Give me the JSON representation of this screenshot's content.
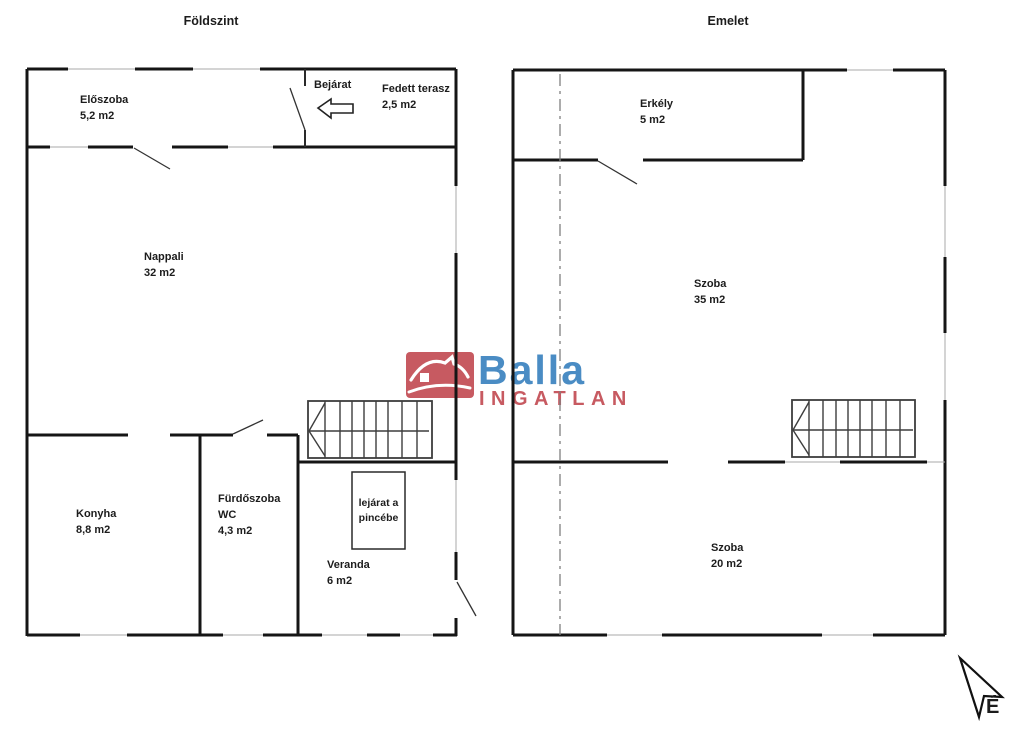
{
  "floors": {
    "ground": {
      "title": "Földszint",
      "rooms": {
        "eloszoba": {
          "name": "Előszoba",
          "area": "5,2 m2"
        },
        "bejarat": {
          "name": "Bejárat"
        },
        "fedett_terasz": {
          "name": "Fedett terasz",
          "area": "2,5 m2"
        },
        "nappali": {
          "name": "Nappali",
          "area": "32 m2"
        },
        "konyha": {
          "name": "Konyha",
          "area": "8,8 m2"
        },
        "furdoszoba": {
          "name": "Fürdőszoba",
          "name2": "WC",
          "area": "4,3 m2"
        },
        "veranda": {
          "name": "Veranda",
          "area": "6 m2"
        },
        "lejarat_pince": {
          "line1": "lejárat a",
          "line2": "pincébe"
        }
      }
    },
    "upper": {
      "title": "Emelet",
      "rooms": {
        "erkely": {
          "name": "Erkély",
          "area": "5 m2"
        },
        "szoba_nagy": {
          "name": "Szoba",
          "area": "35 m2"
        },
        "szoba_kis": {
          "name": "Szoba",
          "area": "20 m2"
        }
      }
    }
  },
  "logo": {
    "brand": "Balla",
    "subtitle": "INGATLAN",
    "colors": {
      "red": "#c75a61",
      "blue": "#4a8cc4"
    }
  },
  "compass": {
    "label": "É"
  }
}
